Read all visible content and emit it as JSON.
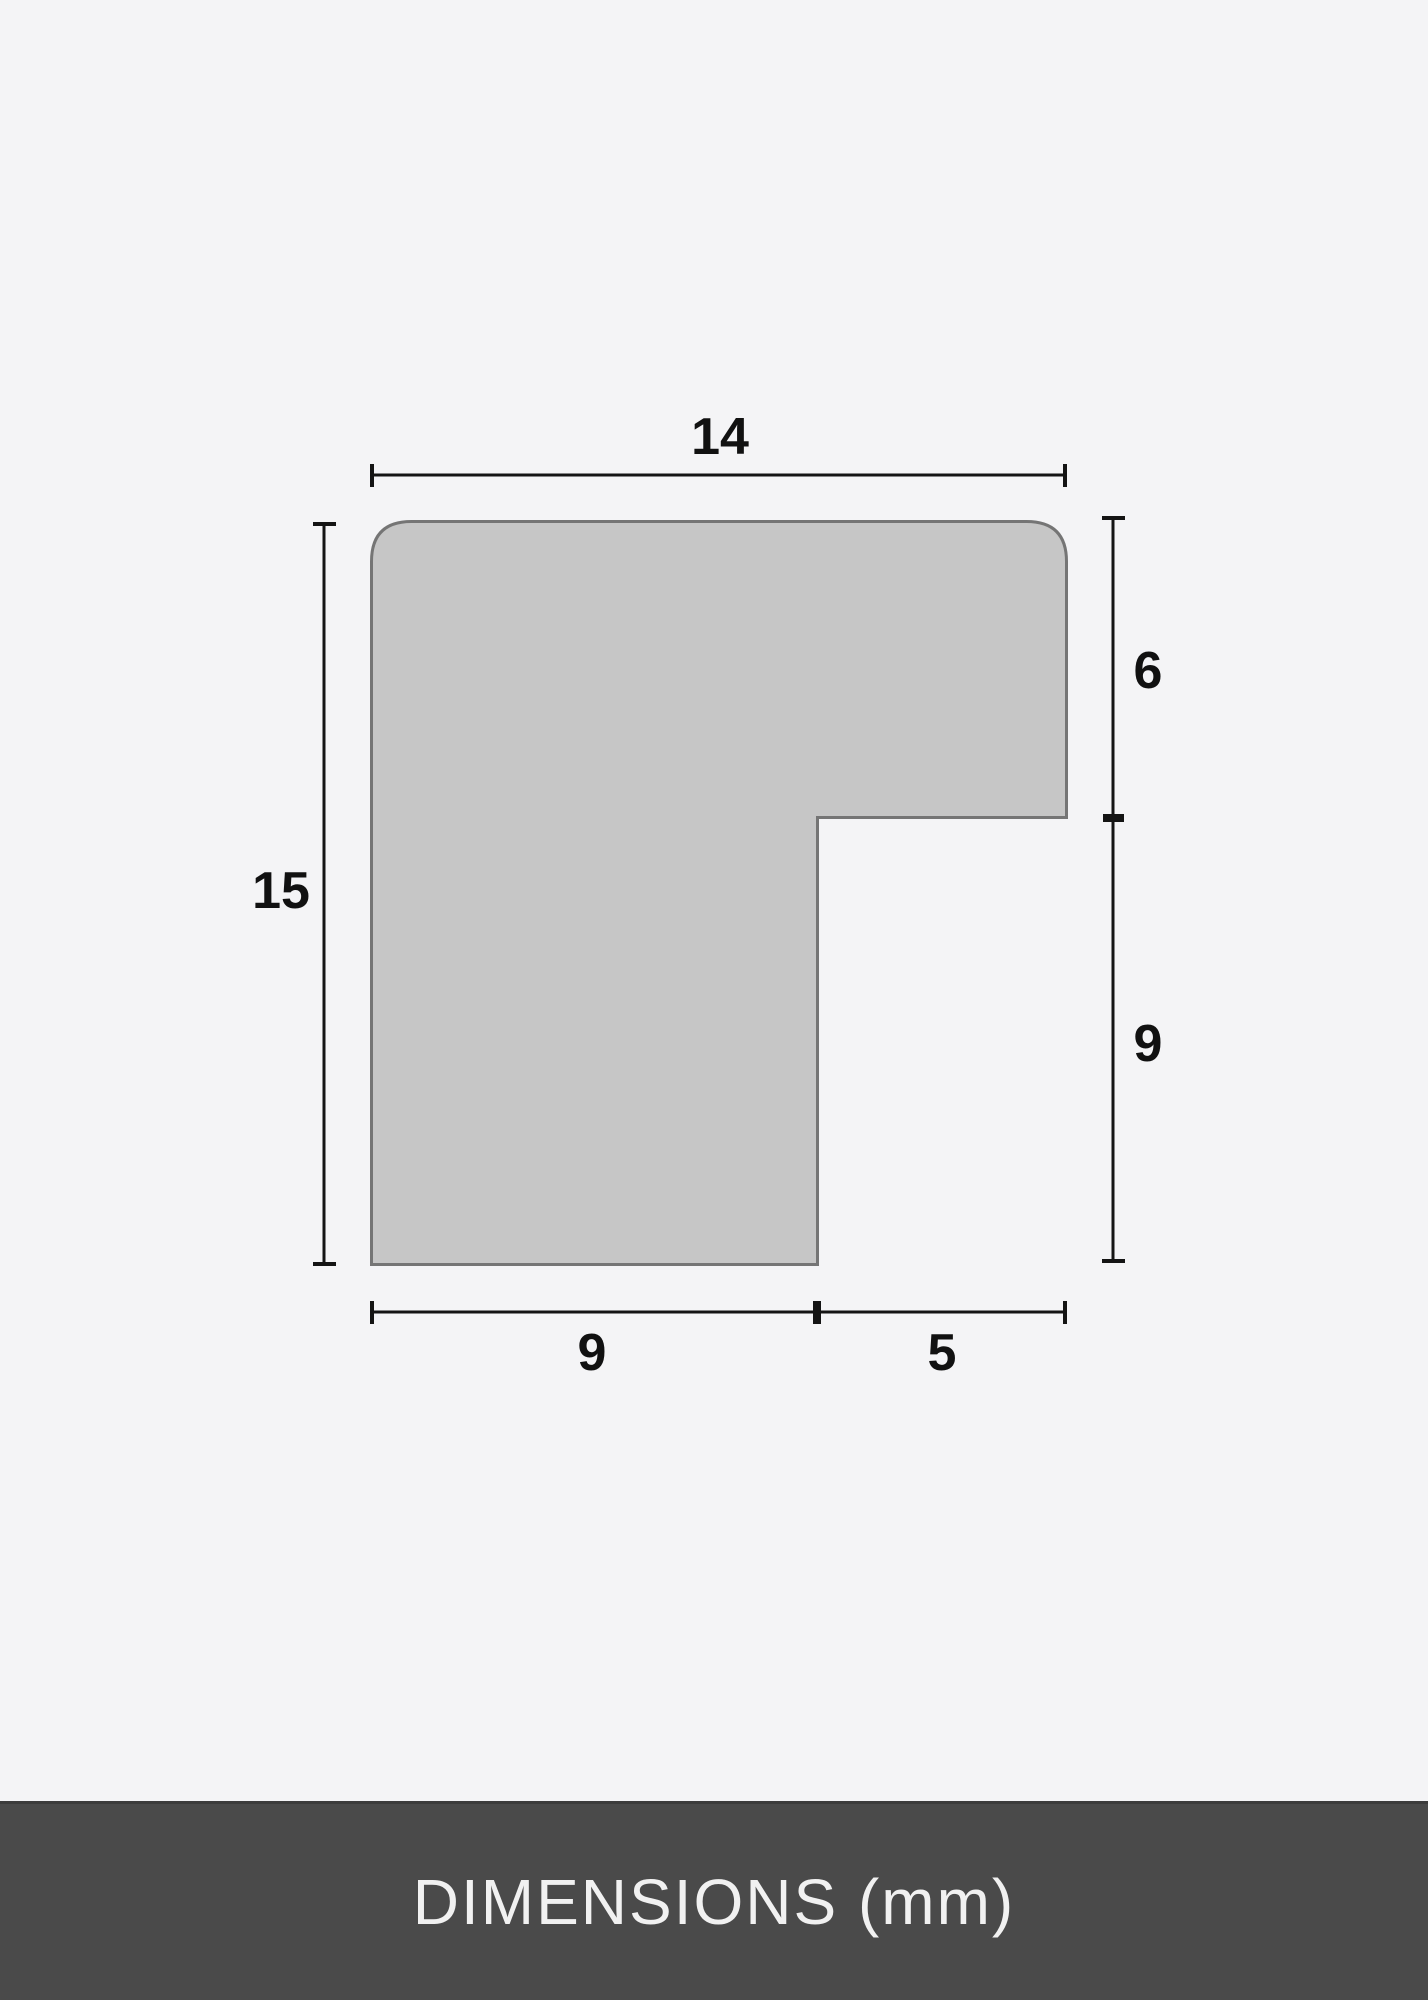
{
  "page": {
    "background": "#f4f4f6"
  },
  "diagram": {
    "shape": {
      "fill": "#c6c6c6",
      "stroke": "#757575"
    },
    "line_color": "#141414",
    "labels": {
      "top_width": "14",
      "left_height": "15",
      "right_upper": "6",
      "right_lower": "9",
      "bottom_left": "9",
      "bottom_right": "5"
    }
  },
  "footer": {
    "label": "DIMENSIONS (mm)",
    "background": "#4a4a4a",
    "text_color": "#f1f1f1"
  }
}
